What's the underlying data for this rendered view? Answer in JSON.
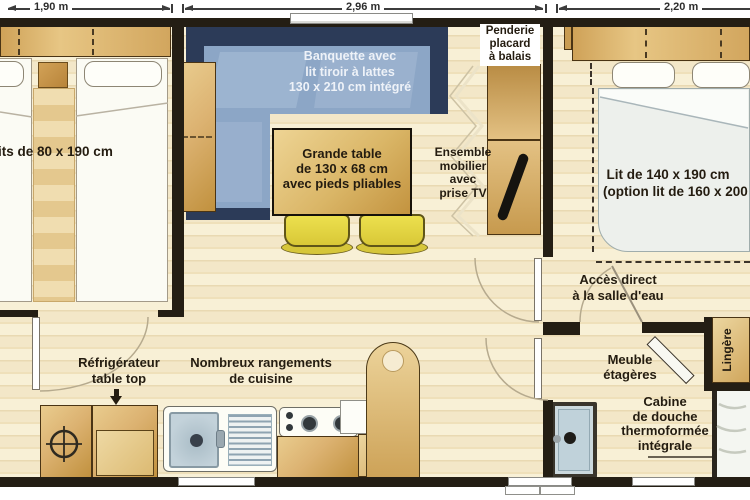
{
  "dimensions": {
    "left": "1,90 m",
    "middle": "2,96 m",
    "right": "2,20 m"
  },
  "left_bedroom": {
    "beds_label": "its de 80 x 190 cm"
  },
  "living": {
    "banquette_lines": [
      "Banquette avec",
      "lit tiroir à lattes",
      "130 x 210 cm intégré"
    ],
    "table_lines": [
      "Grande table",
      "de 130 x 68 cm",
      "avec pieds pliables"
    ],
    "penderie_lines": [
      "Penderie",
      "placard",
      "à balais"
    ],
    "ensemble_lines": [
      "Ensemble",
      "mobilier",
      "avec",
      "prise TV"
    ]
  },
  "right_bedroom": {
    "bed_lines": [
      "Lit de 140 x 190 cm",
      "(option lit de 160 x 200 c"
    ],
    "access_lines": [
      "Accès direct",
      "à la salle d'eau"
    ]
  },
  "kitchen": {
    "fridge_lines": [
      "Réfrigérateur",
      "table top"
    ],
    "storage_lines": [
      "Nombreux rangements",
      "de cuisine"
    ]
  },
  "bathroom": {
    "shelves_lines": [
      "Meuble",
      "étagères"
    ],
    "linen_label": "Lingère",
    "shower_lines": [
      "Cabine",
      "de douche",
      "thermoformée",
      "intégrale"
    ]
  },
  "colors": {
    "wall": "#241e14",
    "floor-light": "#f8f0d6",
    "floor-dark": "#efe0ba",
    "wood-light": "#e9cc8e",
    "wood-dark": "#c1913e",
    "banquette-navy": "#2c3b58",
    "banquette-seat": "#8ca6c6",
    "chair-yellow": "#e5d74a",
    "bed-white": "#fbfbf4",
    "label-ink": "#241c10",
    "sink-steel": "#c3d2da"
  }
}
